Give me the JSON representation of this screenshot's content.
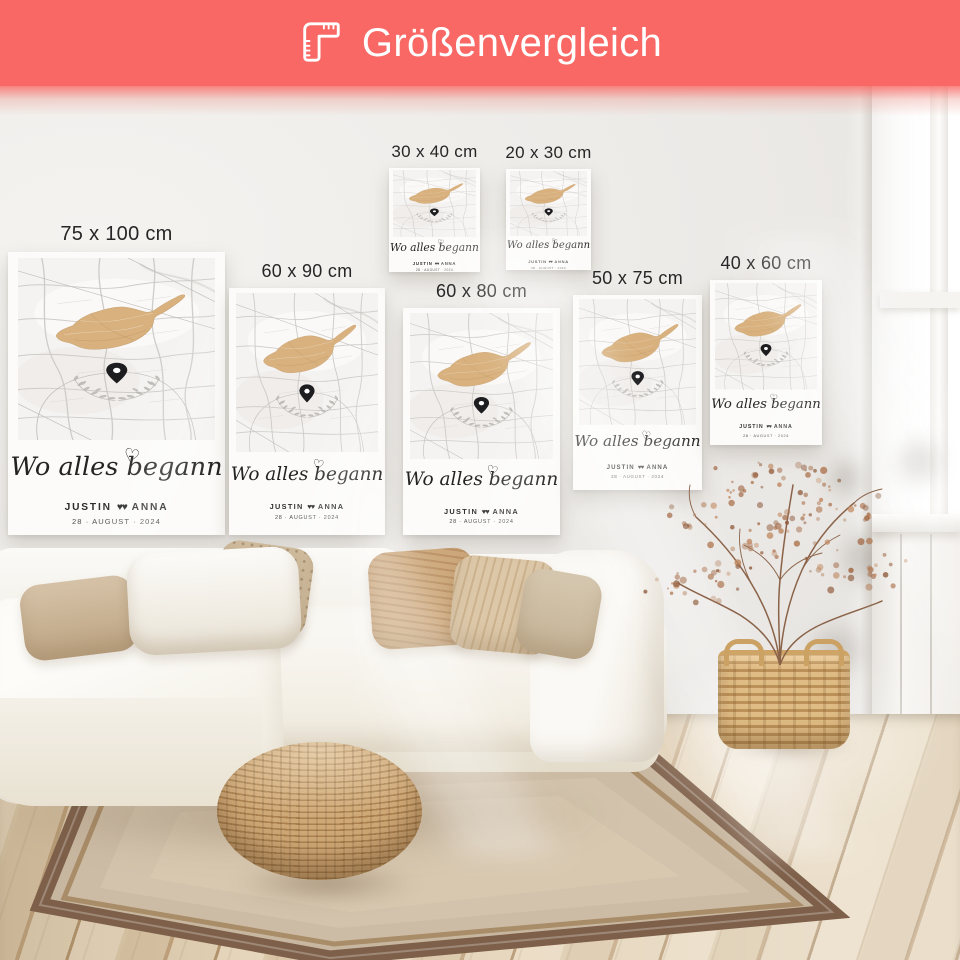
{
  "banner": {
    "title": "Größenvergleich",
    "icon": "corner-ruler-icon",
    "background_color": "#f96864",
    "text_color": "#ffffff"
  },
  "posters": {
    "shared": {
      "headline_script": "Wo alles begann",
      "heart_accent": "♡",
      "name_left": "JUSTIN",
      "hearts_glyph": "♥♥",
      "name_right": "ANNA",
      "date_line": "28 · AUGUST · 2024",
      "island_color": "#d8b17e",
      "pin_color": "#1d1d1f",
      "paper_color": "#fcfbf9"
    },
    "sizes": [
      {
        "label": "75 x 100 cm"
      },
      {
        "label": "60 x 90 cm"
      },
      {
        "label": "30 x 40 cm"
      },
      {
        "label": "20 x 30 cm"
      },
      {
        "label": "60 x 80 cm"
      },
      {
        "label": "50 x 75 cm"
      },
      {
        "label": "40 x 60 cm"
      }
    ]
  },
  "scene": {
    "wall_color": "#edebe8",
    "window_light_color": "#ffffff",
    "floor_wood_light": "#e8d8be",
    "floor_wood_dark": "#b3956e",
    "rug_field_color": "#c8b7a0",
    "rug_border_color": "#7e604a",
    "sofa_fabric_color": "#f5f2ec",
    "pillow_colors": [
      "#d6c3a8",
      "#fcfbf8",
      "#cfbb9d",
      "#cda87c",
      "#dcc7a8",
      "#d6c8b0"
    ],
    "pouf_rattan_color": "#c49e6d",
    "basket_rattan_color": "#d9b57e",
    "plant_foliage_color": "#ab744f"
  }
}
